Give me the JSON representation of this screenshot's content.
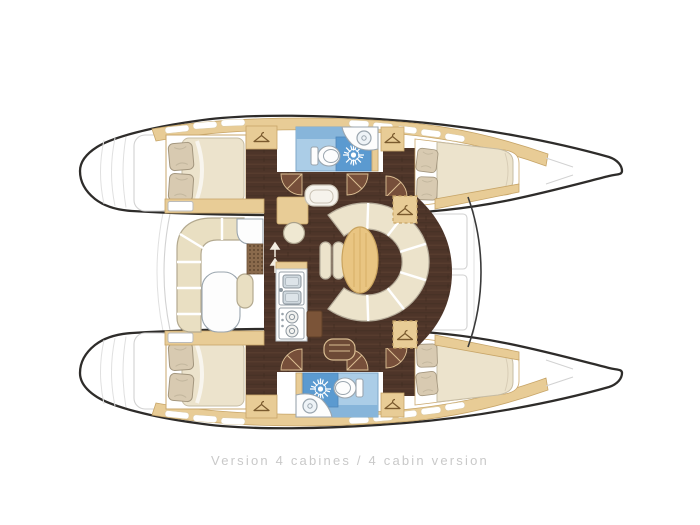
{
  "caption": {
    "text": "Version 4 cabines / 4 cabin version"
  },
  "legend": {
    "cabins_shown": 4,
    "heads_shown": 2,
    "hulls": 2
  },
  "icons": {
    "hanger-icon": "clothes-hanger (triangle with hook) = hanging locker",
    "shower-drain-icon": "white starburst on blue = shower",
    "toilet-icon": "white oval with seat",
    "sink-icon": "circle on white counter",
    "stove-icon": "two burner circles",
    "companionway-arrows-icon": "small up arrows = steps between salon and hull",
    "doormat-icon": "dotted grid rectangle"
  },
  "colors": {
    "background": "#ffffff",
    "hull_outline": "#2e2c2a",
    "faint_line": "#d2d2d2",
    "deck_tan": "#e8cc96",
    "deck_tan_border": "#c7a568",
    "floor_brown": "#4e3529",
    "door_arc": "#774f3a",
    "mattress_cream": "#ece3cc",
    "pillow_beige": "#d8cab1",
    "seat_cream": "#e9dfc2",
    "settee_cream": "#ece3cb",
    "table_wheat": "#e9c582",
    "bath_blue_light": "#abcde7",
    "bath_blue_mid": "#87b5da",
    "bath_blue_dark": "#5b9ad0",
    "fixture_white": "#fdfdfd",
    "fixture_outline": "#9aa5ae",
    "caption_gray": "#c9c9c9"
  }
}
